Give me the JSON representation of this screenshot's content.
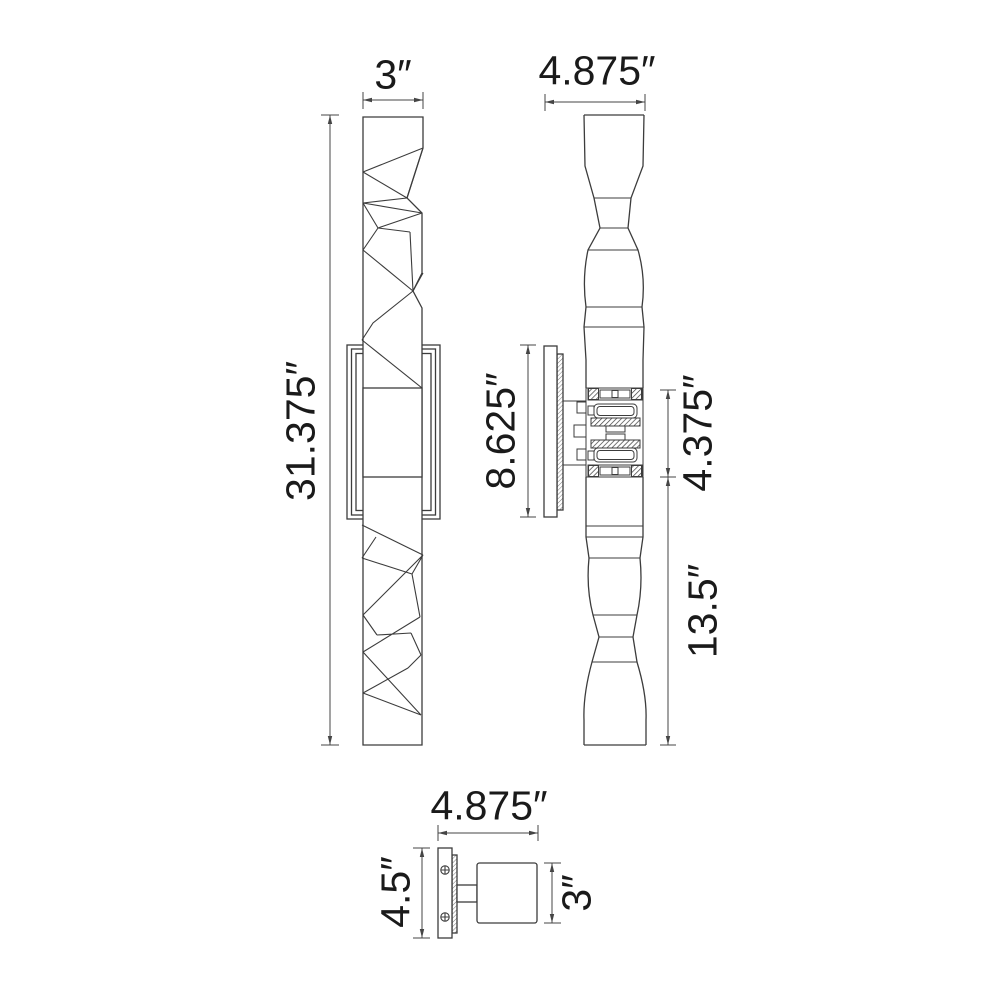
{
  "meta": {
    "drawing_type": "wall sconce technical dimension drawing",
    "background_color": "#ffffff",
    "line_color": "#3c3c3c",
    "dimension_line_color": "#454545",
    "text_color": "#1a1a1a"
  },
  "views": {
    "front": {
      "title": "front view (faceted crystal column with backplate)",
      "width": "3″",
      "height": "31.375″"
    },
    "side": {
      "title": "side profile view (lamp assembly and wall plate)",
      "depth": "4.875″",
      "backplate": "8.625″",
      "center": "4.375″",
      "lower": "13.5″"
    },
    "top": {
      "title": "top view (wall plate, arm and body)",
      "depth": "4.875″",
      "plate": "4.5″",
      "body": "3″"
    }
  }
}
